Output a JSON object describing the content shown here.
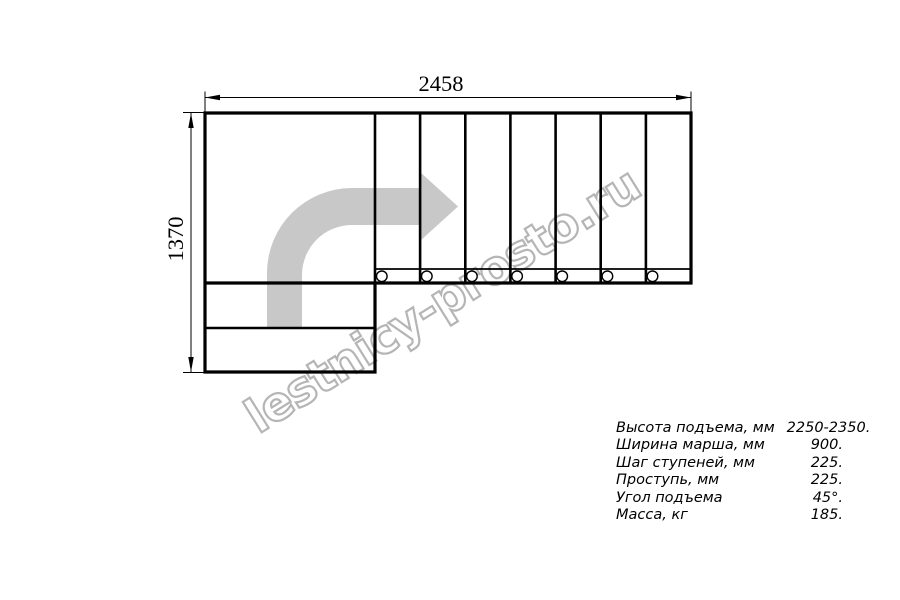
{
  "drawing": {
    "dim_width": "2458",
    "dim_height": "1370",
    "watermark": "lestnicy-prosto.ru",
    "colors": {
      "line": "#000000",
      "arrow_fill": "#c8c8c8",
      "watermark": "#b5b5b5"
    }
  },
  "specs": {
    "rows": [
      {
        "label": "Высота подъема, мм",
        "value": "2250-2350."
      },
      {
        "label": "Ширина марша, мм",
        "value": "900."
      },
      {
        "label": "Шаг ступеней, мм",
        "value": "225."
      },
      {
        "label": "Проступь, мм",
        "value": "225."
      },
      {
        "label": "Угол подъема",
        "value": "45°."
      },
      {
        "label": "Масса, кг",
        "value": "185."
      }
    ]
  }
}
